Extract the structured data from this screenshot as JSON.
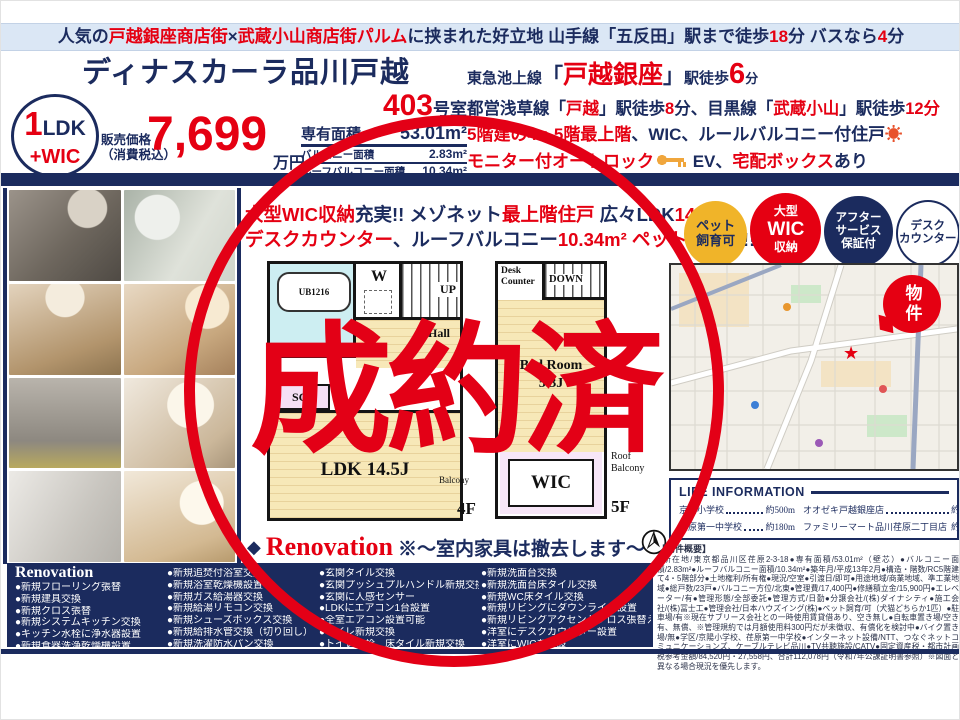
{
  "banner": {
    "segments": [
      {
        "t": "人気の",
        "c": "navy"
      },
      {
        "t": "戸越銀座商店街",
        "c": "red"
      },
      {
        "t": "×",
        "c": "navy"
      },
      {
        "t": "武蔵小山商店街パルム",
        "c": "red"
      },
      {
        "t": "に挟まれた好立地 山手線「五反田」駅まで徒歩",
        "c": "navy"
      },
      {
        "t": "18",
        "c": "red"
      },
      {
        "t": "分 バスなら",
        "c": "navy"
      },
      {
        "t": "4",
        "c": "red"
      },
      {
        "t": "分",
        "c": "navy"
      }
    ]
  },
  "header": {
    "title": "ディナスカーラ品川戸越"
  },
  "unit": {
    "number": "403",
    "suffix": "号室"
  },
  "type_badge": {
    "num": "1",
    "type": "LDK",
    "plus": "+WIC"
  },
  "price": {
    "label_top": "販売価格",
    "label_bottom": "（消費税込）",
    "value": "7,699",
    "unit": "万円"
  },
  "areas": [
    {
      "label": "専有面積",
      "value": "53.01m²"
    },
    {
      "label": "バルコニー面積",
      "value": "2.83m²"
    },
    {
      "label": "ルーフバルコニー面積",
      "value": "10.34m²"
    }
  ],
  "access": {
    "line1": [
      {
        "t": "東急池上線",
        "c": "navy",
        "s": "s15"
      },
      {
        "t": "「",
        "c": "navy",
        "s": "s22"
      },
      {
        "t": "戸越銀座",
        "c": "red",
        "s": "s26"
      },
      {
        "t": "」",
        "c": "navy",
        "s": "s22"
      },
      {
        "t": "駅徒歩",
        "c": "navy",
        "s": "s15"
      },
      {
        "t": "6",
        "c": "red",
        "s": "s30"
      },
      {
        "t": "分",
        "c": "navy",
        "s": "s13"
      }
    ],
    "line2": [
      {
        "t": "都営浅草線「",
        "c": "navy"
      },
      {
        "t": "戸越",
        "c": "red"
      },
      {
        "t": "」駅徒歩",
        "c": "navy"
      },
      {
        "t": "8",
        "c": "red"
      },
      {
        "t": "分、目黒線「",
        "c": "navy"
      },
      {
        "t": "武蔵小山",
        "c": "red"
      },
      {
        "t": "」駅徒歩",
        "c": "navy"
      },
      {
        "t": "12分",
        "c": "red"
      }
    ],
    "line3": [
      {
        "t": "5階建の4・5階最上階",
        "c": "red"
      },
      {
        "t": "、WIC、ルールバルコニー付住戸",
        "c": "navy"
      },
      {
        "t": "☀",
        "c": "sun"
      }
    ],
    "line4": [
      {
        "t": "モニター付オートロック",
        "c": "red"
      },
      {
        "t": "",
        "c": "key"
      },
      {
        "t": " EV、",
        "c": "navy"
      },
      {
        "t": "宅配ボックス",
        "c": "red"
      },
      {
        "t": "あり",
        "c": "navy"
      }
    ]
  },
  "catch": {
    "line1": [
      {
        "t": "大型WIC収納",
        "c": "red"
      },
      {
        "t": "充実!! メゾネット",
        "c": "navy"
      },
      {
        "t": "最上階住戸",
        "c": "red"
      },
      {
        "t": " 広々LDK",
        "c": "navy"
      },
      {
        "t": "14.5J",
        "c": "red"
      }
    ],
    "line2": [
      {
        "t": "デスクカウンター",
        "c": "red"
      },
      {
        "t": "、ルーフバルコニー",
        "c": "navy"
      },
      {
        "t": "10.34m²",
        "c": "red"
      },
      {
        "t": " ペット",
        "c": "red"
      },
      {
        "t": "飼育可!!",
        "c": "navy"
      }
    ]
  },
  "feature_badges": [
    {
      "l1": "ペット",
      "l2": "飼育可",
      "l3": ""
    },
    {
      "l1": "大型",
      "l2": "WIC",
      "l3": "収納"
    },
    {
      "l1": "アフター",
      "l2": "サービス",
      "l3": "保証付"
    },
    {
      "l1": "デスク",
      "l2": "カウンター",
      "l3": ""
    }
  ],
  "photos": [
    "photo-kitchen",
    "photo-bathroom",
    "photo-dining",
    "photo-living",
    "photo-hallway",
    "photo-desk-corner",
    "photo-vanity",
    "photo-bedroom"
  ],
  "floorplan": {
    "plan4": {
      "bath": "UB1216",
      "washer": "W",
      "up": "UP",
      "hall": "Hall",
      "sc": "SC",
      "room": "LDK 14.5J",
      "balcony": "Balcony",
      "floor": "4F"
    },
    "plan5": {
      "desk1": "Desk",
      "desk2": "Counter",
      "down": "DOWN",
      "room1": "Bed Room",
      "room2": "5.3J",
      "wic": "WIC",
      "roof1": "Roof",
      "roof2": "Balcony",
      "floor": "5F"
    }
  },
  "reno_note": {
    "diamond": "◆",
    "title": "Renovation",
    "note": "※〜室内家具は撤去します〜"
  },
  "map": {
    "badge": "物件",
    "marker": "★"
  },
  "life_info": {
    "title": "LIFE INFORMATION",
    "rows": [
      {
        "name": "京陽小学校",
        "dist": "約500m"
      },
      {
        "name": "オオゼキ戸越銀座店",
        "dist": "約350m"
      },
      {
        "name": "荏原第一中学校",
        "dist": "約180m"
      },
      {
        "name": "ファミリーマート品川荏原二丁目店",
        "dist": "約180m"
      }
    ]
  },
  "outline": {
    "header": "【物件概要】",
    "text": "●所在地/東京都品川区荏原2-3-18●専有面積/53.01m²（壁芯）●バルコニー面積/2.83m²●ルーフバルコニー面積/10.34m²●築年月/平成13年2月●構造・階数/RC5階建て4・5階部分●土地権利/所有権●現況/空室●引渡日/即可●用途地域/商業地域、準工業地域●総戸数/23戸●バルコニー方位/北東●管理費/17,400円●修繕積立金/15,900円●エレベーター/有●管理形態/全部委託●管理方式/日勤●分譲会社/(株)ダイナシティ●施工会社/(株)冨士工●管理会社/日本ハウズイング(株)●ペット飼育/可（犬猫どちらか1匹）●駐車場/有※現在サブリース会社との一時使用賃貸借あり、空き無し●自転車置き場/空き有、無償、※管理規約では月額使用料300円だが未徴収、有償化を検討中●バイク置き場/無●学区/京陽小学校、荏原第一中学校●インターネット設備/NTT、つなぐネットコミュニケーションズ、ケーブルテレビ品川●TV共聴施設/CATV●固定資産税・都市計画税参考金額/84,520円・27,558円、合計112,078円（令和7年公課証明書参照）※図面と異なる場合現況を優先します。"
  },
  "renovation": {
    "header": "Renovation",
    "col1": [
      "●新規フローリング張替",
      "●新規建具交換",
      "●新規クロス張替",
      "●新規システムキッチン交換",
      "●キッチン水栓に浄水器設置",
      "●新規食器洗浄乾燥機設置"
    ],
    "col2": [
      "●新規追焚付浴室交換",
      "●新規浴室乾燥機設置",
      "●新規ガス給湯器交換",
      "●新規給湯リモコン交換",
      "●新規シューズボックス交換",
      "●新規給排水管交換（切り回し）",
      "●新規洗濯防水パン交換"
    ],
    "col3": [
      "●玄関タイル交換",
      "●玄関プッシュプルハンドル新規交換",
      "●玄関に人感センサー",
      "●LDKにエアコン1台設置",
      "●全室エアコン設置可能",
      "●トイレ新規交換",
      "●トイレ水栓、床タイル新規交換"
    ],
    "col4": [
      "●新規洗面台交換",
      "●新規洗面台床タイル交換",
      "●新規WC床タイル交換",
      "●新規リビングにダウンライト設置",
      "●新規リビングアクセントクロス張替え",
      "●洋室にデスクカウンター設置",
      "●洋室にWICを新設"
    ]
  },
  "stamp": {
    "text": "成約済"
  }
}
